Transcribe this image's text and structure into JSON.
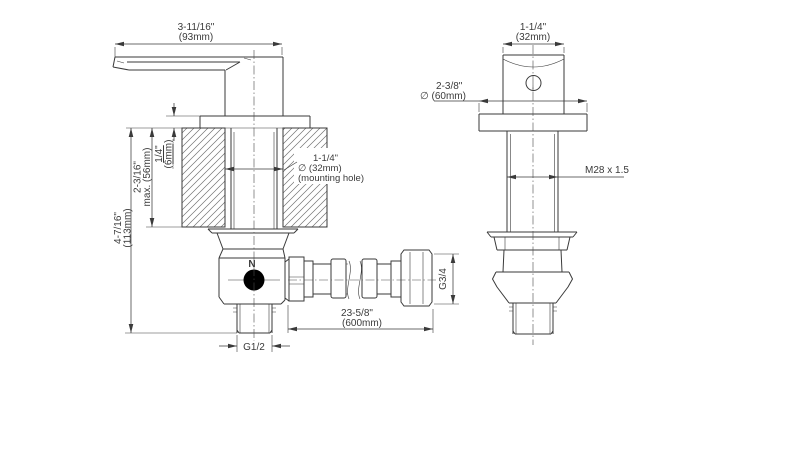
{
  "page": {
    "background": "#ffffff",
    "line_color": "#3a3a3a",
    "text_color": "#3a3a3a",
    "indicator_dot_color": "#000000"
  },
  "side_view": {
    "lever_width": {
      "inches": "3-11/16\"",
      "metric": "(93mm)"
    },
    "plate_thickness": {
      "inches": "1/4\"",
      "metric": "(6mm)"
    },
    "deck_thickness": {
      "inches": "2-3/16\"",
      "metric": "max. (56mm)"
    },
    "install_depth": {
      "inches": "4-7/16\"",
      "metric": "(113mm)"
    },
    "mounting_hole": {
      "inches": "1-1/4\"",
      "metric": "∅ (32mm)",
      "note": "(mounting hole)"
    },
    "body_marker": "N",
    "outlet_thread": "G1/2",
    "hose_length": {
      "inches": "23-5/8\"",
      "metric": "(600mm)"
    },
    "hose_nut_thread": "G3/4"
  },
  "front_view": {
    "handle_width": {
      "inches": "1-1/4\"",
      "metric": "(32mm)"
    },
    "escutcheon_diameter": {
      "inches": "2-3/8\"",
      "metric": "∅ (60mm)"
    },
    "shank_thread": "M28 x 1.5"
  }
}
